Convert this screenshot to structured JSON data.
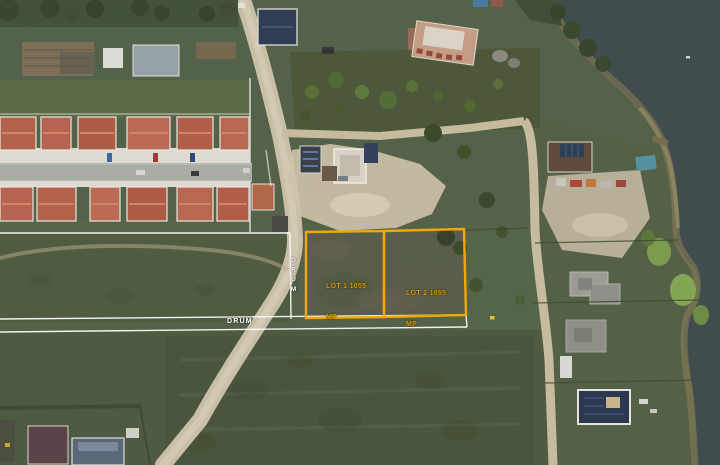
{
  "annotations": {
    "lot1": {
      "line1": "LOT 1 1055",
      "line2": "MP"
    },
    "lot2": {
      "line1": "LOT 2 1055",
      "line2": "MP"
    },
    "vertical_road_label": "DRUM",
    "horizontal_road_label": "DRUM",
    "colors": {
      "lot_outline": "#F2A800",
      "lot_text": "#DD9406",
      "boundary_line": "#FFFFFF",
      "water": "#414C4F",
      "field_green": "#4E5B3E",
      "dirt_road": "#C9BFA6",
      "house_roof": "#B2614B"
    }
  }
}
